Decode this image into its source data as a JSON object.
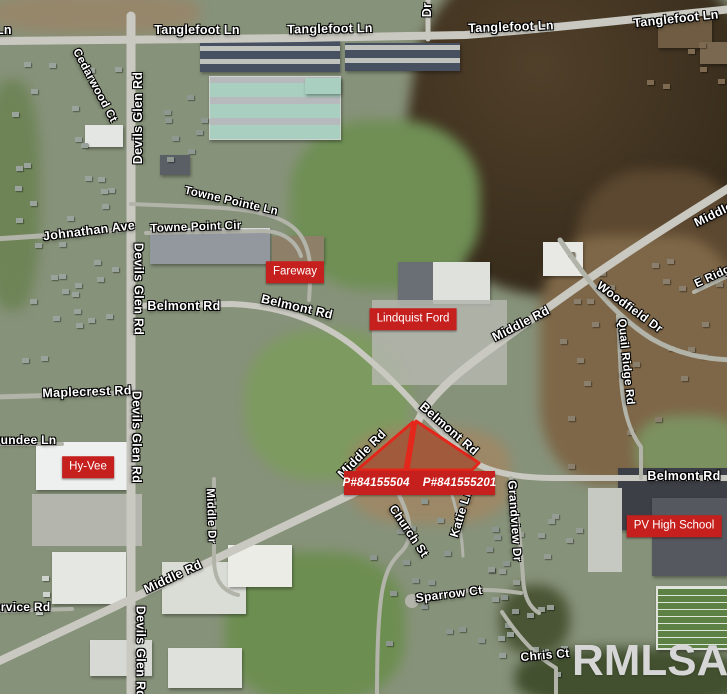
{
  "map": {
    "watermark": "RMLSA",
    "colors": {
      "poi_box_red": "#c5201e",
      "parcel_outline_red": "#e4261b",
      "road_label_white": "#ffffff",
      "watermark_gray": "#d6d6d6"
    },
    "parcel_overlay": {
      "labels": [
        "P#84155504",
        "P#841555201"
      ]
    },
    "poi_boxes": [
      {
        "label": "Fareway",
        "x": 295,
        "y": 272
      },
      {
        "label": "Lindquist Ford",
        "x": 413,
        "y": 319
      },
      {
        "label": "Hy-Vee",
        "x": 88,
        "y": 467
      },
      {
        "label": "PV High School",
        "x": 674,
        "y": 526
      }
    ],
    "road_labels": [
      {
        "text": "Tanglefoot Ln",
        "x": -31,
        "y": 30,
        "rot": 0
      },
      {
        "text": "Tanglefoot Ln",
        "x": 197,
        "y": 30,
        "rot": 0
      },
      {
        "text": "Tanglefoot Ln",
        "x": 330,
        "y": 29,
        "rot": -1
      },
      {
        "text": "Tanglefoot Ln",
        "x": 511,
        "y": 27,
        "rot": -2
      },
      {
        "text": "Tanglefoot Ln",
        "x": 676,
        "y": 19,
        "rot": -6
      },
      {
        "text": "Dr",
        "x": 427,
        "y": 10,
        "rot": -90
      },
      {
        "text": "Cedarwood Ct",
        "x": 94,
        "y": 86,
        "rot": 62,
        "size": 11.5
      },
      {
        "text": "Devils Glen Rd",
        "x": 138,
        "y": 118,
        "rot": -90
      },
      {
        "text": "Devils Glen Rd",
        "x": 138,
        "y": 289,
        "rot": 90
      },
      {
        "text": "Devils Glen Rd",
        "x": 136,
        "y": 437,
        "rot": 90
      },
      {
        "text": "Devils Glen Rd",
        "x": 140,
        "y": 652,
        "rot": 90
      },
      {
        "text": "Johnathan Ave",
        "x": 89,
        "y": 231,
        "rot": -7
      },
      {
        "text": "Towne Pointe Ln",
        "x": 231,
        "y": 202,
        "rot": 13,
        "size": 11.5
      },
      {
        "text": "Towne Point Cir",
        "x": 196,
        "y": 228,
        "rot": -2,
        "size": 11.5
      },
      {
        "text": "Belmont Rd",
        "x": 184,
        "y": 306,
        "rot": 0
      },
      {
        "text": "Belmont Rd",
        "x": 297,
        "y": 307,
        "rot": 13
      },
      {
        "text": "Middle Rd",
        "x": 521,
        "y": 324,
        "rot": -27
      },
      {
        "text": "Middle Rd",
        "x": 723,
        "y": 210,
        "rot": -26
      },
      {
        "text": "E Ridge",
        "x": 716,
        "y": 276,
        "rot": -25,
        "size": 11.5
      },
      {
        "text": "Woodfield Dr",
        "x": 630,
        "y": 307,
        "rot": 36,
        "size": 12
      },
      {
        "text": "Quail Ridge Rd",
        "x": 625,
        "y": 362,
        "rot": 84,
        "size": 11.5
      },
      {
        "text": "Maplecrest Rd",
        "x": 87,
        "y": 392,
        "rot": -2
      },
      {
        "text": "Dundee Ln",
        "x": 24,
        "y": 440,
        "rot": 0,
        "size": 12
      },
      {
        "text": "Middle Dr",
        "x": 210,
        "y": 516,
        "rot": 88,
        "size": 11.5
      },
      {
        "text": "Belmont Rd",
        "x": 449,
        "y": 429,
        "rot": 41
      },
      {
        "text": "Middle Rd",
        "x": 362,
        "y": 454,
        "rot": -45
      },
      {
        "text": "Church St",
        "x": 409,
        "y": 531,
        "rot": 56,
        "size": 12
      },
      {
        "text": "Katie Ln",
        "x": 461,
        "y": 513,
        "rot": -73,
        "size": 12
      },
      {
        "text": "Grandview Dr",
        "x": 515,
        "y": 521,
        "rot": 86,
        "size": 12
      },
      {
        "text": "Sparrow Ct",
        "x": 449,
        "y": 594,
        "rot": -7,
        "size": 12
      },
      {
        "text": "Middle Rd",
        "x": 173,
        "y": 577,
        "rot": -25
      },
      {
        "text": "Service Rd",
        "x": 18,
        "y": 607,
        "rot": 0,
        "size": 12
      },
      {
        "text": "Chris Ct",
        "x": 545,
        "y": 655,
        "rot": -5,
        "size": 12
      },
      {
        "text": "Belmont Rd",
        "x": 684,
        "y": 476,
        "rot": 0
      }
    ]
  }
}
